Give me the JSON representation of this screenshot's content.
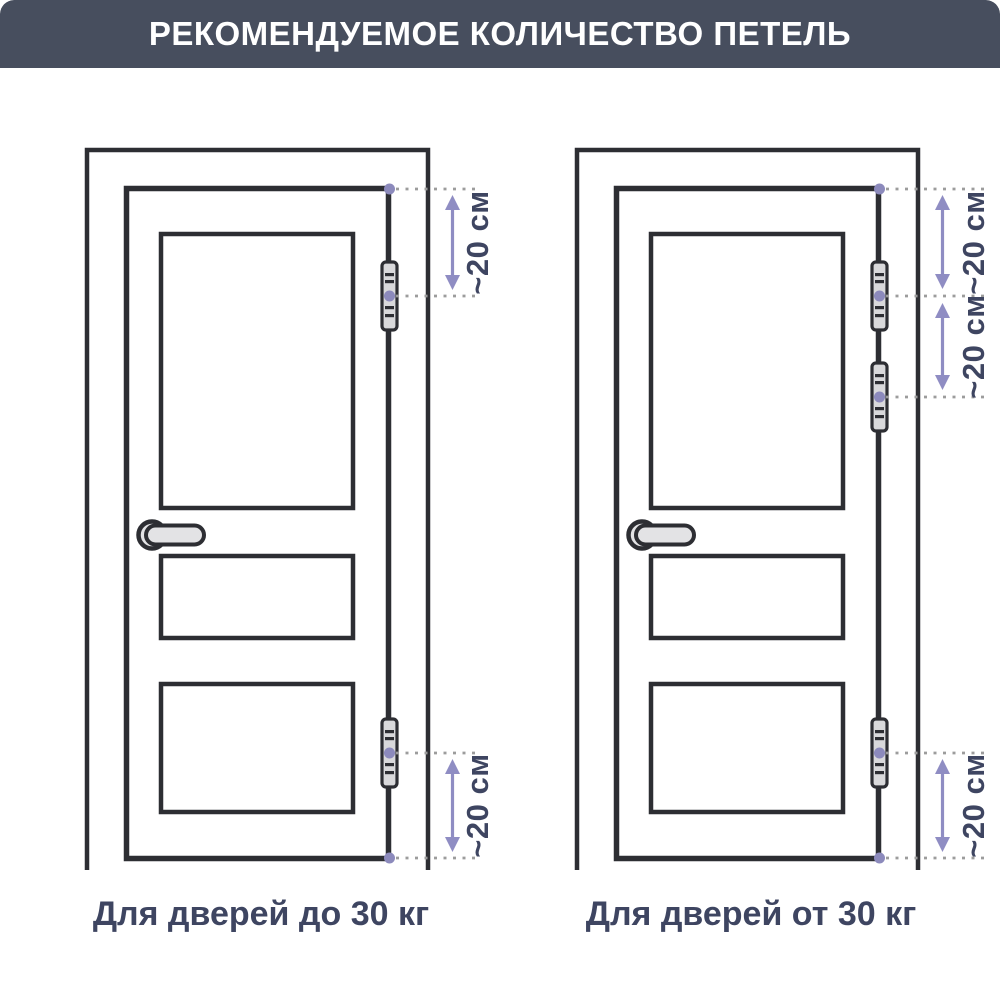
{
  "title": "РЕКОМЕНДУЕМОЕ КОЛИЧЕСТВО ПЕТЕЛЬ",
  "colors": {
    "banner_bg": "#474e5e",
    "title_text": "#ffffff",
    "line_art": "#2d2e33",
    "hinge_fill": "#d9d9db",
    "handle_fill": "#e3e3e5",
    "dimension_accent": "#8c8abc",
    "leader_dotted": "#9c9c9c",
    "caption_text": "#3e4561"
  },
  "diagrams": [
    {
      "caption": "Для дверей до 30 кг",
      "hinge_count": 2,
      "dimensions": [
        {
          "label": "~20 см",
          "from": "door-top-corner",
          "to": "upper-hinge-center"
        },
        {
          "label": "~20 см",
          "from": "lower-hinge-center",
          "to": "door-bottom-corner"
        }
      ]
    },
    {
      "caption": "Для дверей от 30 кг",
      "hinge_count": 3,
      "dimensions": [
        {
          "label": "~20 см",
          "from": "door-top-corner",
          "to": "first-hinge-center"
        },
        {
          "label": "~20 см",
          "from": "first-hinge-center",
          "to": "second-hinge-center"
        },
        {
          "label": "~20 см",
          "from": "lower-hinge-center",
          "to": "door-bottom-corner"
        }
      ]
    }
  ]
}
